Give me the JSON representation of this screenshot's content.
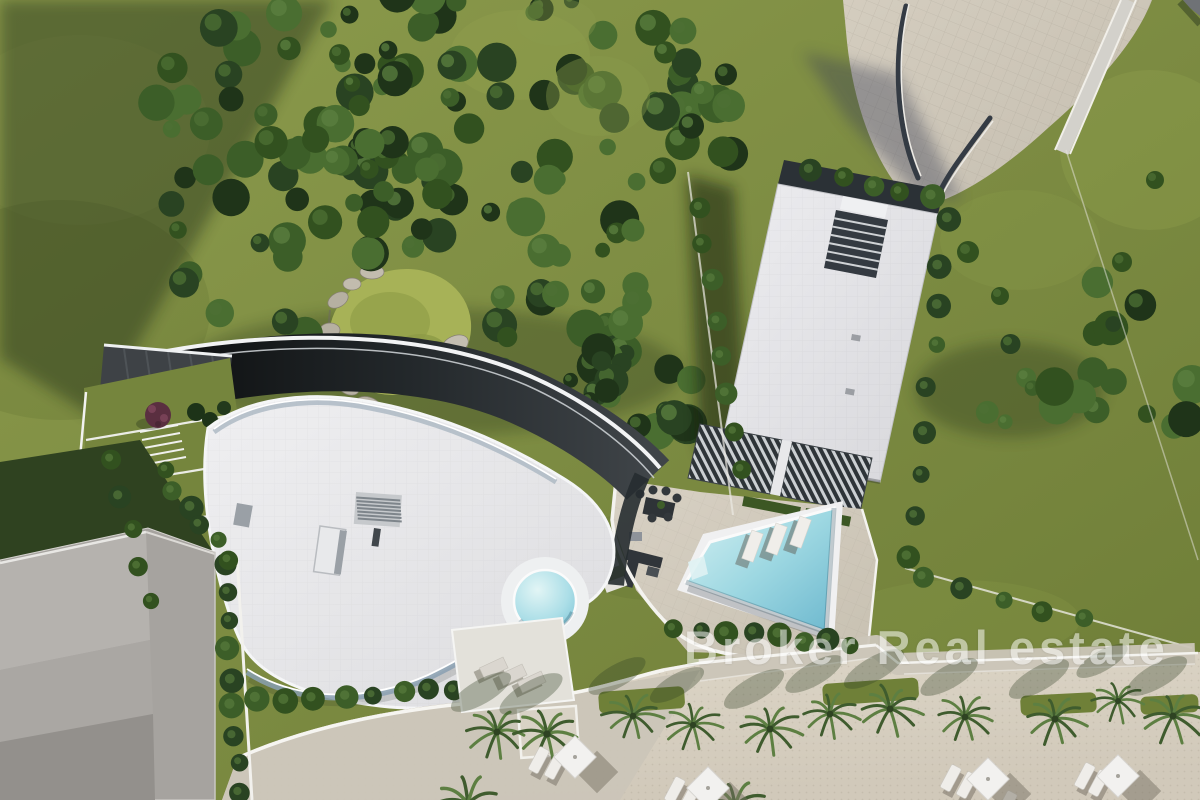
{
  "watermark": {
    "text": "Broker Real estate",
    "color": "#ffffff"
  },
  "labels": {
    "scene": "Aerial 3D render of seaside villas",
    "forest": "Dense garden trees",
    "left_villa": "Curved villa with round plunge pool and ramp driveway",
    "right_villa": "Modern rectangular villa with rooftop stairwell",
    "pool_terrace": "Pool terrace with rectangular swimming pool and sun loungers",
    "round_pool": "Round plunge pool",
    "neighbor": "Neighbouring flat-roof building",
    "promenade": "Beach promenade with palm trees and sun umbrellas",
    "paving": "Paved driveway and parking area",
    "rock_garden": "Rock garden with pond"
  },
  "palette": {
    "grass": "#7b8a41",
    "grassLight": "#97a755",
    "grassDark": "#5d7030",
    "treeDark": "#24391c",
    "roofWhite": "#e4e4e7",
    "terraceWhite": "#e9e9ec",
    "paving": "#cec7b9",
    "sand": "#d9d2c3",
    "walk": "#cbc5b8",
    "asphalt": "#212629",
    "poolBlue": "#9ed8e2",
    "poolDeep": "#74bdd3",
    "glass": "#8aa0b2",
    "neighborGray": "#a6a39f",
    "wallWhite": "#f4f3ef",
    "furnitureDark": "#33383b",
    "shadow": "#1c2913"
  }
}
